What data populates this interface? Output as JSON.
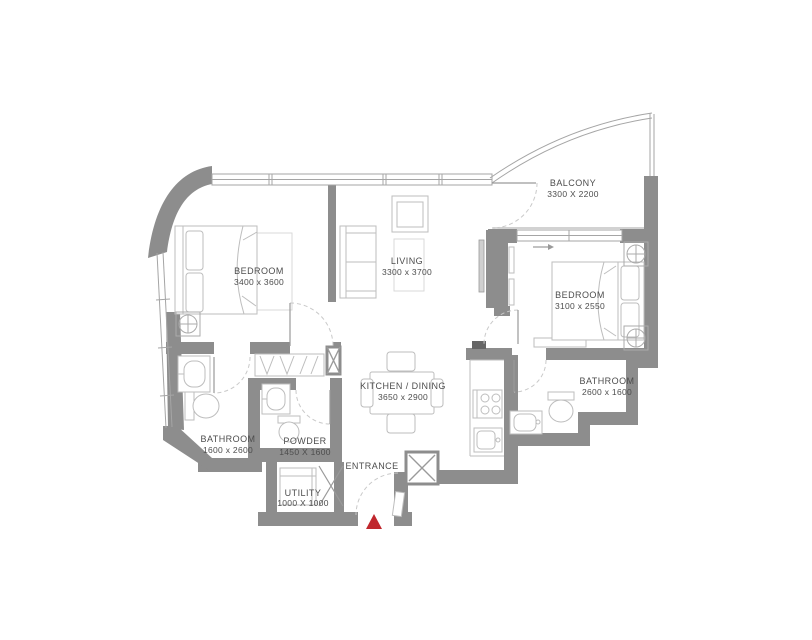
{
  "plan": {
    "title": "apartment-floor-plan",
    "colors": {
      "wall": "#8d8d8d",
      "window_line": "#a5a5a5",
      "furniture_line": "#bdbdbd",
      "text": "#4d4d4d",
      "entrance_marker": "#c0272d"
    },
    "rooms": [
      {
        "id": "bedroom-1",
        "name": "BEDROOM",
        "dims": "3400 x 3600"
      },
      {
        "id": "living",
        "name": "LIVING",
        "dims": "3300 x 3700"
      },
      {
        "id": "balcony",
        "name": "BALCONY",
        "dims": "3300 X 2200"
      },
      {
        "id": "bedroom-2",
        "name": "BEDROOM",
        "dims": "3100 x 2550"
      },
      {
        "id": "kitchen-dining",
        "name": "KITCHEN / DINING",
        "dims": "3650 x 2900"
      },
      {
        "id": "bathroom-1",
        "name": "BATHROOM",
        "dims": "1600 x 2600"
      },
      {
        "id": "powder",
        "name": "POWDER",
        "dims": "1450 X 1600"
      },
      {
        "id": "bathroom-2",
        "name": "BATHROOM",
        "dims": "2600 x 1600"
      },
      {
        "id": "utility",
        "name": "UTILITY",
        "dims": "1000 X 1000"
      }
    ],
    "entrance_label": "ENTRANCE"
  }
}
